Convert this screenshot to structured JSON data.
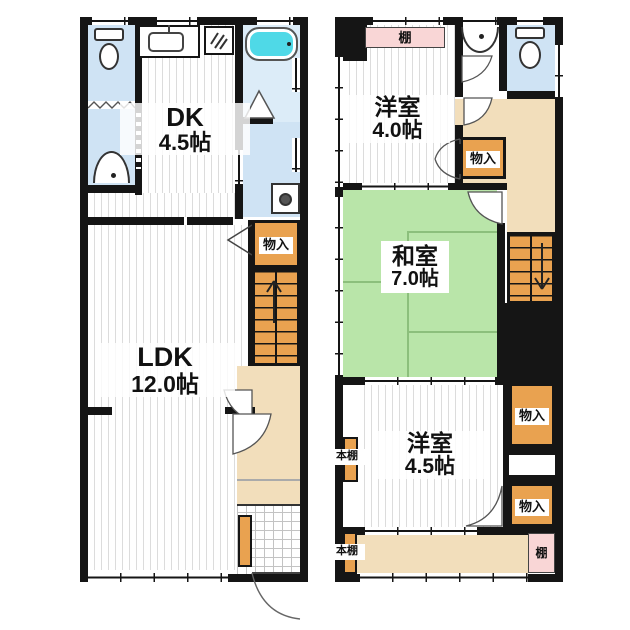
{
  "floor1": {
    "dk_label": {
      "name": "DK",
      "area": "4.5帖"
    },
    "ldk_label": {
      "name": "LDK",
      "area": "12.0帖"
    },
    "closet_label": "物入"
  },
  "floor2": {
    "shelf_top_label": "棚",
    "western_room_1": {
      "name": "洋室",
      "area": "4.0帖"
    },
    "hall_closet_label": "物入",
    "japanese_room": {
      "name": "和室",
      "area": "7.0帖"
    },
    "western_room_2": {
      "name": "洋室",
      "area": "4.5帖"
    },
    "closet_upper_label": "物入",
    "closet_lower_label": "物入",
    "bookshelf_upper_label": "本棚",
    "bookshelf_lower_label": "本棚",
    "shelf_bottom_label": "棚"
  },
  "colors": {
    "wall": "#151515",
    "water_blue": "#cfe3f4",
    "bath_cyan": "#4fd9e7",
    "tatami_green": "#b9e5a9",
    "storage_orange": "#e9a250",
    "hall_beige": "#f2debb",
    "shelf_pink": "#f9d6d6"
  },
  "icons": {
    "toilet": "toilet-icon",
    "washbasin": "washbasin-icon",
    "kitchen_sink": "kitchen-sink-icon",
    "gas_stove": "stove-icon",
    "bathtub": "bathtub-icon",
    "washing_machine": "washing-machine-icon",
    "stairs_up": "stairs-up-arrow-icon",
    "stairs_down": "stairs-down-arrow-icon"
  }
}
